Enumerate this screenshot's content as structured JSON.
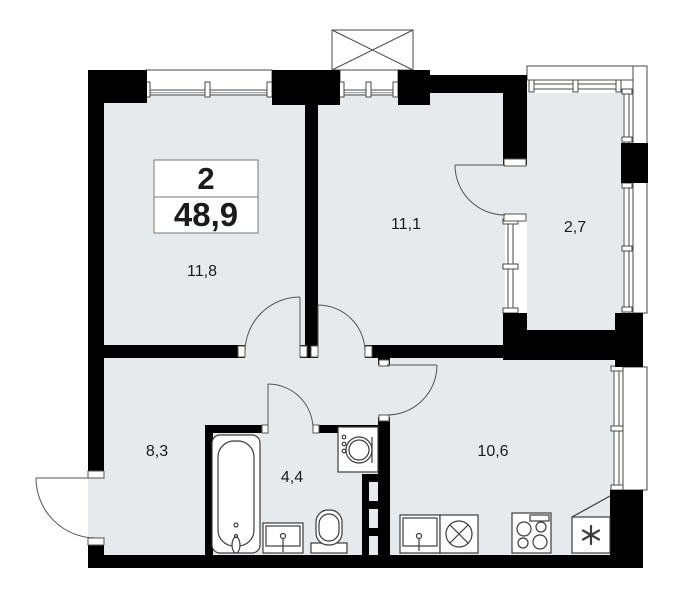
{
  "plan": {
    "type": "apartment-floorplan",
    "summary": {
      "rooms_count": "2",
      "total_area": "48,9"
    },
    "room_labels": {
      "living": "11,8",
      "bedroom": "11,1",
      "balcony": "2,7",
      "hallway": "8,3",
      "bathroom": "4,4",
      "kitchen": "10,6"
    },
    "colors": {
      "wall": "#000000",
      "floor_fill": "#e7eaec",
      "line": "#4a4a4a",
      "background": "#ffffff"
    },
    "fixtures": [
      "bathtub",
      "bathroom-sink",
      "toilet",
      "washing-machine",
      "towel-ladder",
      "kitchen-sink",
      "dishwasher",
      "stove",
      "refrigerator",
      "ventilation-shaft"
    ]
  }
}
